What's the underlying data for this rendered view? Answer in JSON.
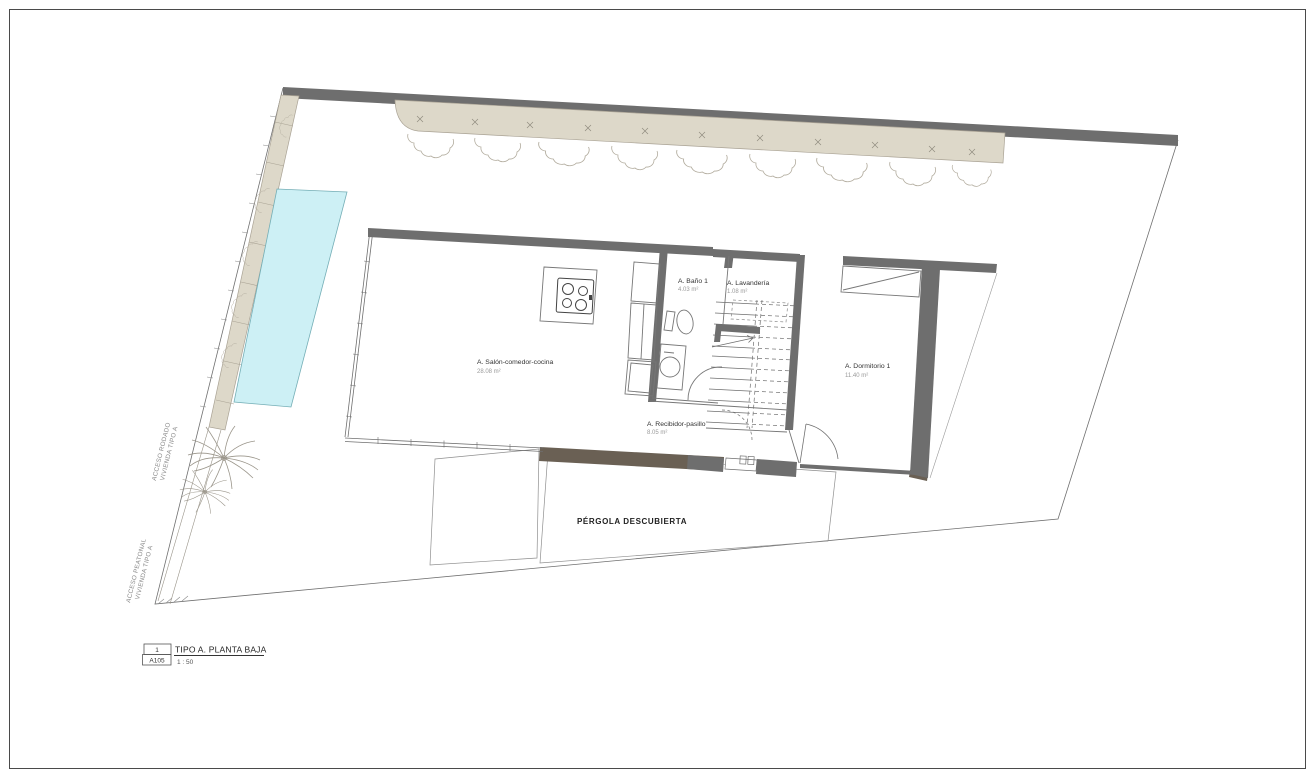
{
  "plan": {
    "rooms": [
      {
        "name": "A. Salón-comedor-cocina",
        "area": "28.08 m²"
      },
      {
        "name": "A. Baño 1",
        "area": "4.03 m²"
      },
      {
        "name": "A. Lavandería",
        "area": "1.08 m²"
      },
      {
        "name": "A. Dormitorio 1",
        "area": "11.40 m²"
      },
      {
        "name": "A. Recibidor-pasillo",
        "area": "8.05 m²"
      }
    ],
    "outdoor": {
      "pergola_label": "PÉRGOLA DESCUBIERTA"
    },
    "access": {
      "rodado_line1": "ACCESO RODADO",
      "rodado_line2": "VIVIENDA TIPO A",
      "peatonal_line1": "ACCESO PEATONAL",
      "peatonal_line2": "VIVIENDA TIPO A"
    },
    "colors": {
      "wall": "#6e6e6e",
      "planting": "#ddd8c9",
      "pool": "#cdf0f5",
      "deck": "#6a6054"
    }
  },
  "title_block": {
    "detail_number": "1",
    "sheet_code": "A105",
    "title": "TIPO A. PLANTA BAJA",
    "scale": "1 : 50"
  }
}
